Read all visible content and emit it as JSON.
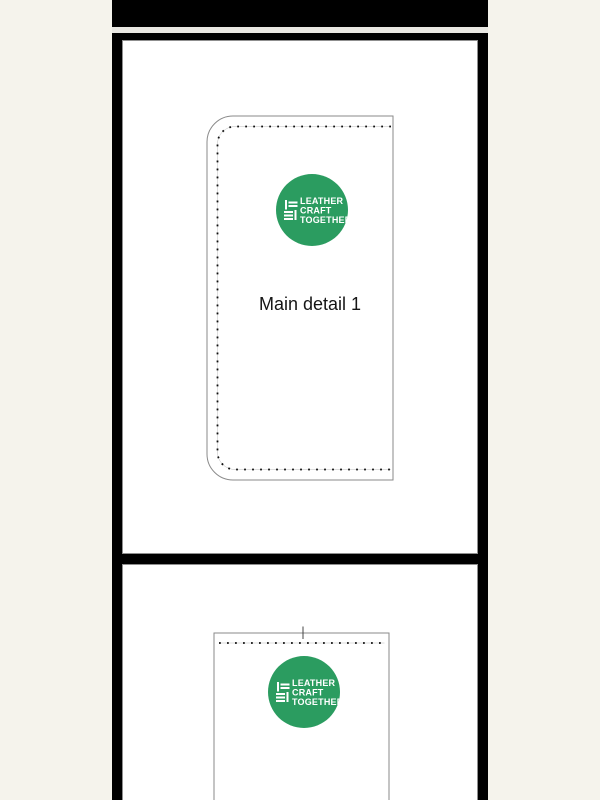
{
  "viewer": {
    "background_color": "#f5f3ec",
    "page_background": "#ffffff",
    "frame_color": "#000000",
    "hairline_color": "#8f8f8f",
    "outline_color": "#8a8a8a",
    "stitch_color": "#111111"
  },
  "brand_logo": {
    "lines": [
      "LEATHER",
      "CRAFT",
      "TOGETHER"
    ],
    "circle_color": "#2b9c60",
    "text_color": "#ffffff"
  },
  "pages": [
    {
      "name": "page-1",
      "piece_label": "Main detail 1"
    },
    {
      "name": "page-2",
      "piece_label": ""
    }
  ]
}
